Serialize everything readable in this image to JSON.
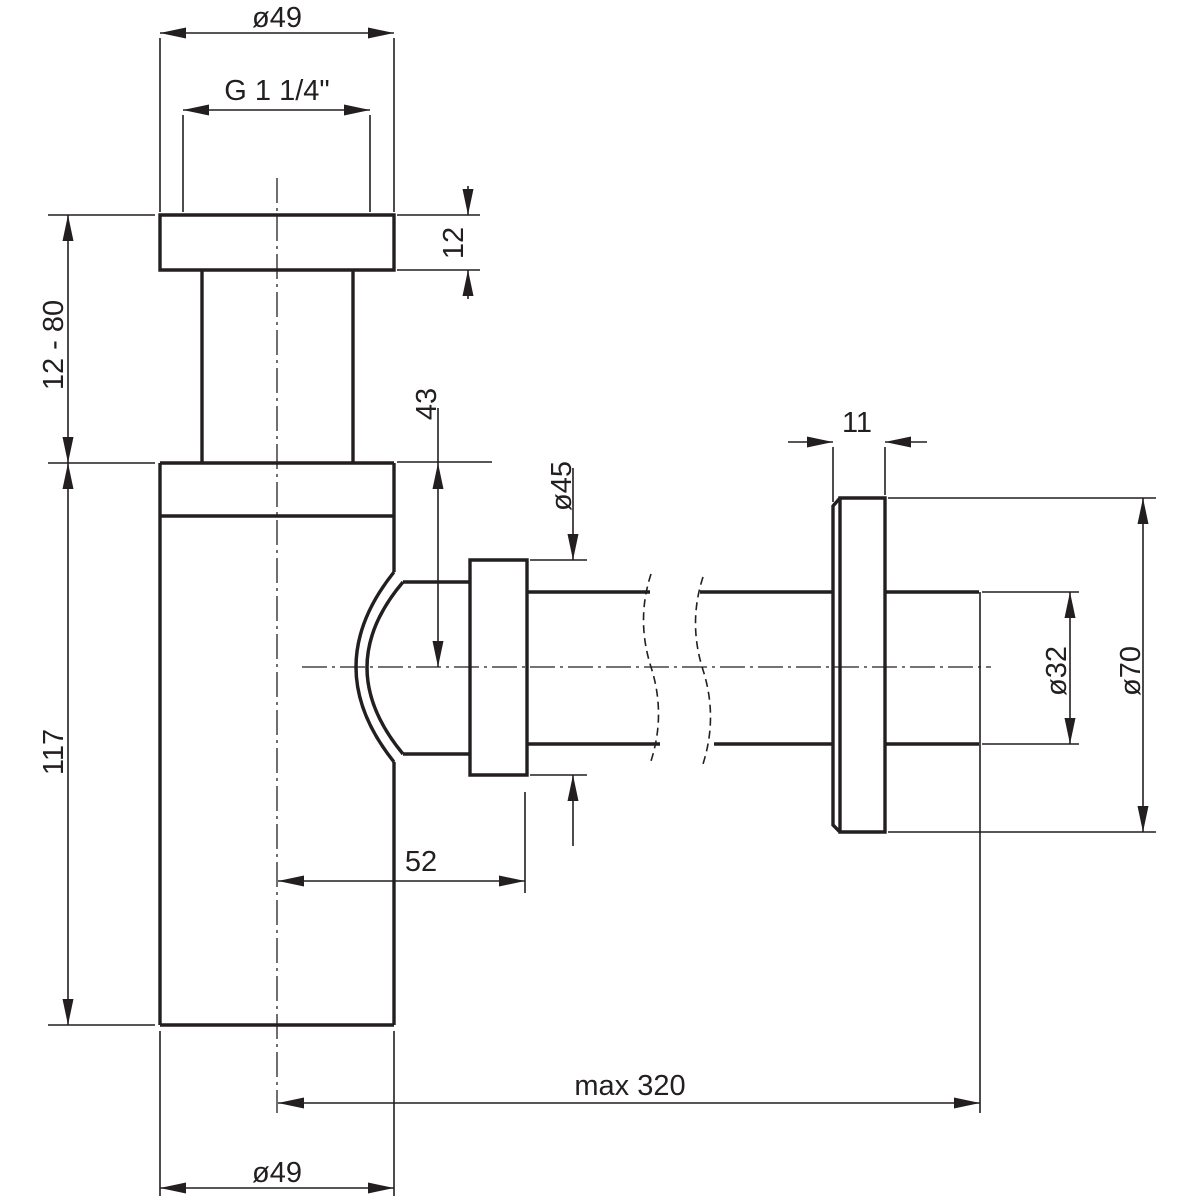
{
  "drawing": {
    "type": "technical-dimension-drawing",
    "subject": "bottle-trap-siphon-with-wall-outlet",
    "background_color": "#ffffff",
    "line_color": "#231f20",
    "labels": {
      "top_diameter": "ø49",
      "thread_size": "G 1 1/4\"",
      "top_nut_height": "12",
      "adjustment_range": "12 - 80",
      "body_height": "117",
      "outlet_center_depth": "43",
      "outlet_nut_diameter": "ø45",
      "outlet_offset": "52",
      "rosette_depth": "11",
      "pipe_diameter": "ø32",
      "rosette_diameter": "ø70",
      "max_length": "max 320",
      "body_diameter": "ø49"
    }
  }
}
